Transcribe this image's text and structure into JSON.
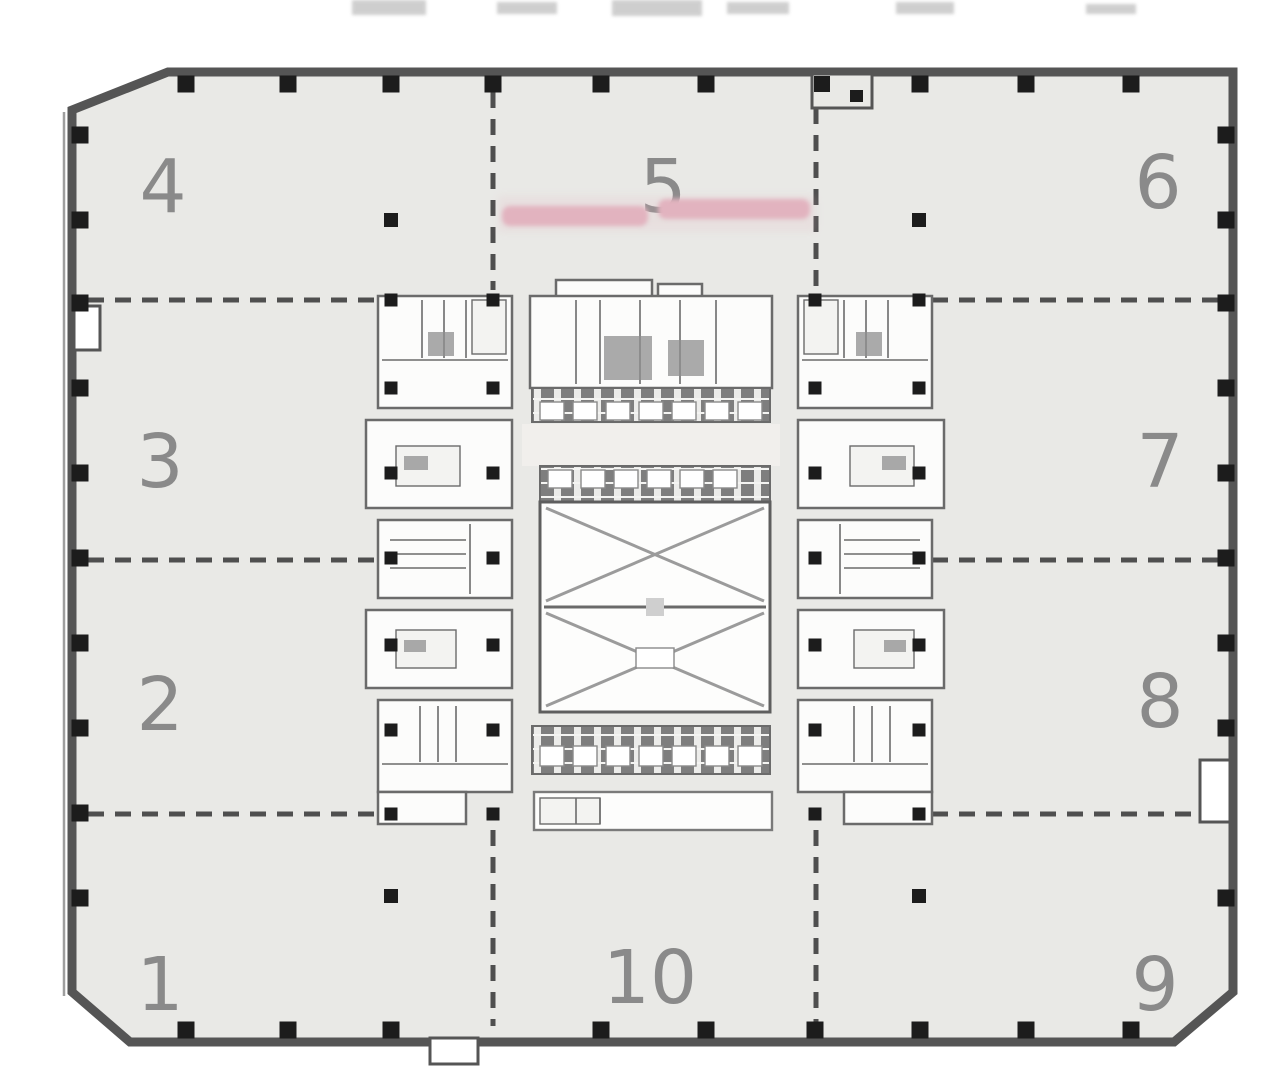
{
  "plan": {
    "zones": {
      "z1": {
        "label": "1"
      },
      "z2": {
        "label": "2"
      },
      "z3": {
        "label": "3"
      },
      "z4": {
        "label": "4"
      },
      "z5": {
        "label": "5"
      },
      "z6": {
        "label": "6"
      },
      "z7": {
        "label": "7"
      },
      "z8": {
        "label": "8"
      },
      "z9": {
        "label": "9"
      },
      "z10": {
        "label": "10"
      }
    },
    "pink_annotations": {
      "left": {
        "text": ""
      },
      "right": {
        "text": ""
      }
    },
    "colors": {
      "floor": "#e9e9e6",
      "wall": "#555555",
      "column": "#1c1c1c",
      "dashed_line": "#4f4f4f",
      "zone_label": "#8a8a8a",
      "core_fill": "#fcfcfb",
      "core_stroke": "#6b6b6b",
      "hatch_dark": "#7e7e7e",
      "pink_annotation": "#e2b3bf"
    }
  }
}
